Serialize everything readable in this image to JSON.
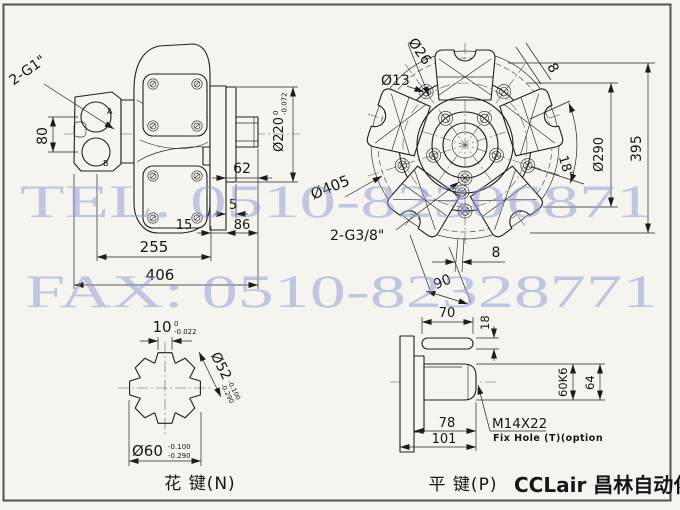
{
  "watermark": {
    "tel": "TEL. 0510-82306871",
    "fax": "FAX: 0510-82328771",
    "color": "#8e9dd6"
  },
  "colors": {
    "paper": "#f6f4ef",
    "line": "#1f1f1f",
    "frame": "#55524c"
  },
  "side_view": {
    "port_label": "2-G1\"",
    "port_a": "A",
    "port_b": "B",
    "dim_80": "80",
    "dim_220": "Ø220",
    "dim_220_tol_up": "0",
    "dim_220_tol_dn": "-0.072",
    "dim_62": "62",
    "dim_5": "5",
    "dim_15": "15",
    "dim_86": "86",
    "dim_255": "255",
    "dim_406": "406"
  },
  "front_view": {
    "dim_d26": "Ø26",
    "dim_d13": "Ø13",
    "dim_8_top": "8",
    "dim_18deg": "18°",
    "dim_d290": "Ø290",
    "dim_395": "395",
    "dim_d405": "Ø405",
    "port_label": "2-G3/8\"",
    "dim_8_bottom": "8",
    "dim_90": "90"
  },
  "spline_view": {
    "caption": "花 键(N)",
    "dim_10": "10",
    "dim_10_tol_up": "0",
    "dim_10_tol_dn": "-0.022",
    "dim_d52": "Ø52",
    "dim_d52_tol_up": "-0.100",
    "dim_d52_tol_dn": "-0.290",
    "dim_d60": "Ø60",
    "dim_d60_tol_up": "-0.100",
    "dim_d60_tol_dn": "-0.290"
  },
  "key_view": {
    "caption": "平 键(P)",
    "dim_70": "70",
    "dim_18": "18",
    "dim_60k6": "60K6",
    "dim_64": "64",
    "dim_78": "78",
    "dim_101": "101",
    "thread": "M14X22",
    "fix_hole_note": "Fix Hole (T)(option"
  },
  "branding": {
    "text": "CCLair 昌林自动化"
  }
}
